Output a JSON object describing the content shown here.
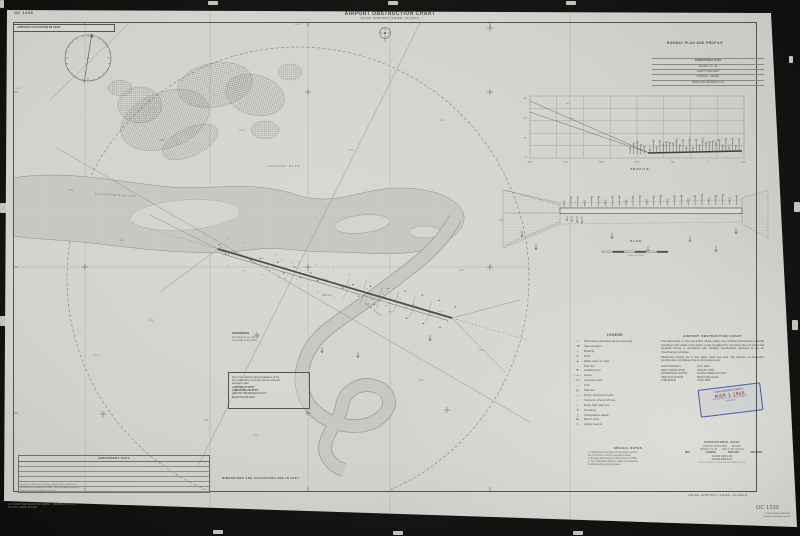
{
  "page": {
    "chart_no_top": "OC 1233",
    "title": "AIRPORT OBSTRUCTION CHART",
    "subtitle": "ANIAK AIRPORT, ANIAK, ALASKA",
    "elevation_note": "AIRPORT ELEVATION 88 FEET",
    "units_note": "DIMENSIONS AND ELEVATIONS ARE IN FEET"
  },
  "map_labels": {
    "plan_area": "AIRPORT PLAN",
    "river_main": "KUSKOKWIM RIVER",
    "river_branch": "ANIAK RIVER",
    "town": "ANIAK",
    "lat_tick": "61°35'",
    "lon_tick": "159°32'"
  },
  "soundings_note": {
    "title": "SOUNDINGS",
    "lines": [
      "Soundings in feet refer to",
      "river stage of July 1954"
    ]
  },
  "reference_box": {
    "lines": [
      "This chart complies with specifications of the",
      "Air Coordinating Committee and amendments",
      "adopted to date."
    ],
    "cols": [
      {
        "label": "LATITUDE",
        "value": "61°34'52\""
      },
      {
        "label": "LONGITUDE",
        "value": "159°32'35\""
      }
    ],
    "footer_lines": [
      "AIRPORT REFERENCE POINT",
      "ELEVATION 88 FEET"
    ]
  },
  "runway_section": {
    "header": "RUNWAY PLAN AND PROFILE",
    "data_box": {
      "title": "OPERATIONAL DATA",
      "rows": [
        "RUNWAY 10 - 28",
        "LENGTH 4000 FEET",
        "SURFACE - GRAVEL",
        "EFFECTIVE GRADIENT 0.2%"
      ]
    },
    "profile_caption": "PROFILE",
    "plan_caption": "PLAN",
    "plan_scale": "SCALE OF FEET",
    "slope_label_1": "40:1",
    "slope_label_2": "50:1",
    "profile_y_labels": [
      "300",
      "200",
      "100",
      "SL"
    ],
    "profile_x_labels": [
      "5000",
      "4000",
      "3000",
      "2000",
      "1000",
      "0",
      "1000"
    ]
  },
  "legend": {
    "title": "LEGEND",
    "items": [
      {
        "sym": "⊥",
        "label": "Obstruction (elevation above sea level)"
      },
      {
        "sym": "· 85",
        "label": "Spot elevation"
      },
      {
        "sym": "▪",
        "label": "Building"
      },
      {
        "sym": "●",
        "label": "Tank"
      },
      {
        "sym": "▲",
        "label": "Radio tower or mast"
      },
      {
        "sym": "- - -",
        "label": "Pole line"
      },
      {
        "sym": "✻",
        "label": "Isolated trees"
      },
      {
        "sym": "—x—",
        "label": "Fence"
      },
      {
        "sym": "══",
        "label": "Improved road"
      },
      {
        "sym": "- -",
        "label": "Trail"
      },
      {
        "sym": "┼┼",
        "label": "Railroad"
      },
      {
        "sym": "—·—",
        "label": "Power transmission line"
      },
      {
        "sym": "∽",
        "label": "Contours, interval 25 feet"
      },
      {
        "sym": "≈",
        "label": "Mean high water line"
      },
      {
        "sym": "8",
        "label": "Sounding"
      },
      {
        "sym": "△",
        "label": "Triangulation station"
      },
      {
        "sym": "⊠",
        "label": "Bench mark"
      },
      {
        "sym": "✶",
        "label": "Airport beacon"
      }
    ]
  },
  "description": {
    "title": "AIRPORT OBSTRUCTION CHART",
    "para1": "This chart shows, in plan and profile, objects which may constitute obstructions to aircraft operating in the vicinity of the airport. It was compiled from surveys by the U.S. Coast and Geodetic Survey in accordance with standard specifications approved by the Air Coordinating Committee.",
    "para2": "Obstruction heights are in feet above mean sea level. The absence of obstruction symbols does not indicate that no obstructions exist.",
    "facts": [
      {
        "label": "PHOTOGRAPHY",
        "value": "JULY 1954"
      },
      {
        "label": "FIELD INSPECTION",
        "value": "AUGUST 1954"
      },
      {
        "label": "HORIZONTAL DATUM",
        "value": "NORTH AMERICAN 1927"
      },
      {
        "label": "VERTICAL DATUM",
        "value": "MEAN SEA LEVEL"
      },
      {
        "label": "PUBLISHED",
        "value": "JUNE 1955"
      }
    ]
  },
  "stamp": {
    "line1": "DOCUMENTS DEPT.",
    "date": "MAR 1 1956",
    "line2": "UNIVERSITY OF CALIFORNIA",
    "line3": "LIBRARY"
  },
  "special_notes": {
    "title": "SPECIAL NOTES",
    "lines": [
      "1. Obstructions less than 25 feet above ground",
      "are not shown except in approach areas.",
      "2. Runway data based on field survey of 1954.",
      "3. The Kuskokwim River is subject to seasonal",
      "flooding during spring breakup."
    ]
  },
  "operational_data": {
    "title": "OPERATIONAL DATA",
    "info_rows": [
      "AIRPORT ELEVATION . . . 88 FEET",
      "RUNWAY 10-28 . . . 4000 X 100 GRAVEL"
    ],
    "table": {
      "headers": [
        "RWY",
        "LANDING",
        "TAKE-OFF",
        "GRADIENT"
      ],
      "rows_flat": [
        "10   4000   4000   0.2%",
        "28   4000   4000   0.2%"
      ]
    },
    "footnote": "FOR COMPLETE DATA SEE AIRMAN'S GUIDE"
  },
  "amendments": {
    "title": "AMENDMENT DATA",
    "rows": [
      "",
      "",
      "",
      "",
      "",
      ""
    ],
    "note_lines": [
      "Corrections affecting the safety of flight will be published in",
      "NOTAMS and the Airman's Guide. This chart will be reissued",
      "when accumulated changes warrant."
    ]
  },
  "footer": {
    "airport": "ANIAK AIRPORT, ANIAK, ALASKA",
    "chart_no": "OC 1233",
    "imprint1": "C 55-8-2 EGE (20JUN55)",
    "imprint2": "Coast and Geodetic Survey",
    "fineprint1": "U.S. COAST AND GEODETIC SURVEY · WASHINGTON, D.C.",
    "fineprint2": "OC 1233 · ANIAK, ALASKA"
  },
  "colors": {
    "stamp_blue": "#3d52a5",
    "stamp_red": "#b03a30",
    "ink": "#4c4c47",
    "paper": "#d2d3cf"
  }
}
